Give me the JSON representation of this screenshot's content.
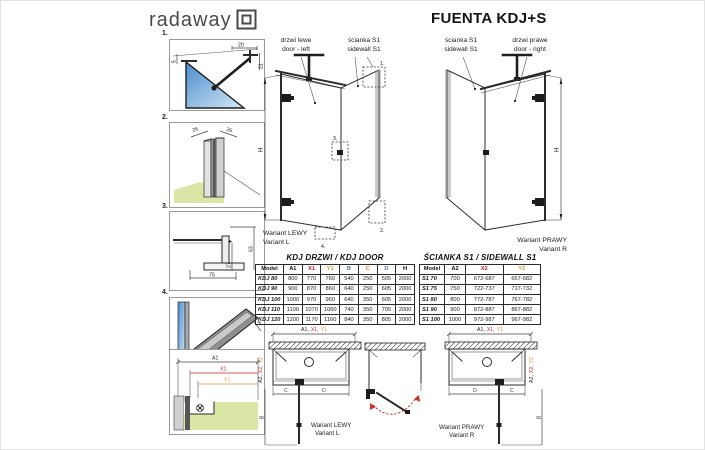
{
  "header": {
    "logo_text": "radaway",
    "title": "FUENTA KDJ+S"
  },
  "colors": {
    "red": "#c1272d",
    "orange": "#dd9933",
    "blue": "#5a6fae",
    "floor": "#d9e6a5",
    "glass": "#4a8ccc",
    "glass_light": "#d6e9f8",
    "ink": "#222222"
  },
  "details": {
    "d1": {
      "num": "1.",
      "top": "20",
      "left": "5",
      "right": "21"
    },
    "d2": {
      "num": "2.",
      "left": "26",
      "right": "26"
    },
    "d3": {
      "num": "3.",
      "width": "75",
      "inner": "27",
      "right": "63"
    },
    "d4": {
      "num": "4.",
      "bottom": "8",
      "side": "8"
    }
  },
  "labels": {
    "iso_left": {
      "door_pl": "drzwi lewe",
      "door_en": "door - left",
      "side_pl": "ścianka S1",
      "side_en": "sidewall S1"
    },
    "iso_right": {
      "side_pl": "ścianka S1",
      "side_en": "sidewall S1",
      "door_pl": "drzwi prawe",
      "door_en": "door - right"
    }
  },
  "iso": {
    "h": "H",
    "callouts": {
      "c1": "1.",
      "c2": "2.",
      "c3": "3.",
      "c4": "4."
    }
  },
  "variants": {
    "left_pl": "Wariant LEWY",
    "left_en": "Variant L",
    "right_pl": "Wariant PRAWY",
    "right_en": "Variant R"
  },
  "door_table": {
    "title": "KDJ DRZWI / KDJ DOOR",
    "headers": [
      "Model",
      "A1",
      "X1",
      "Y1",
      "B",
      "C",
      "D",
      "H"
    ],
    "header_colors": [
      "#111111",
      "#111111",
      "#c1272d",
      "#dd9933",
      "#5a6fae",
      "#cc8833",
      "#5a6fae",
      "#111111"
    ],
    "rows": [
      [
        "KDJ 80",
        "800",
        "770",
        "760",
        "540",
        "250",
        "505",
        "2000"
      ],
      [
        "KDJ 90",
        "900",
        "870",
        "860",
        "640",
        "250",
        "605",
        "2000"
      ],
      [
        "KDJ 100",
        "1000",
        "970",
        "960",
        "640",
        "350",
        "605",
        "2000"
      ],
      [
        "KDJ 110",
        "1100",
        "1070",
        "1060",
        "740",
        "350",
        "705",
        "2000"
      ],
      [
        "KDJ 120",
        "1200",
        "1170",
        "1160",
        "840",
        "350",
        "805",
        "2000"
      ]
    ]
  },
  "sidewall_table": {
    "title": "ŚCIANKA S1 / SIDEWALL S1",
    "headers": [
      "Model",
      "A2",
      "X2",
      "Y2"
    ],
    "header_colors": [
      "#111111",
      "#111111",
      "#c1272d",
      "#dd9933"
    ],
    "rows": [
      [
        "S1 70",
        "700",
        "672-687",
        "667-682"
      ],
      [
        "S1 75",
        "750",
        "722-737",
        "717-732"
      ],
      [
        "S1 80",
        "800",
        "772-787",
        "767-782"
      ],
      [
        "S1 90",
        "900",
        "872-887",
        "867-882"
      ],
      [
        "S1 100",
        "1000",
        "972-987",
        "967-982"
      ]
    ]
  },
  "plan_detail": {
    "a1": "A1",
    "x1": "X1",
    "y1": "Y1"
  },
  "plans": {
    "top_a1": "A1,",
    "top_x1": "X1,",
    "top_y1": "Y1",
    "side_a2": "A2,",
    "side_x2": "X2,",
    "side_y2": "Y2",
    "b": "B",
    "c": "C",
    "d": "D"
  }
}
